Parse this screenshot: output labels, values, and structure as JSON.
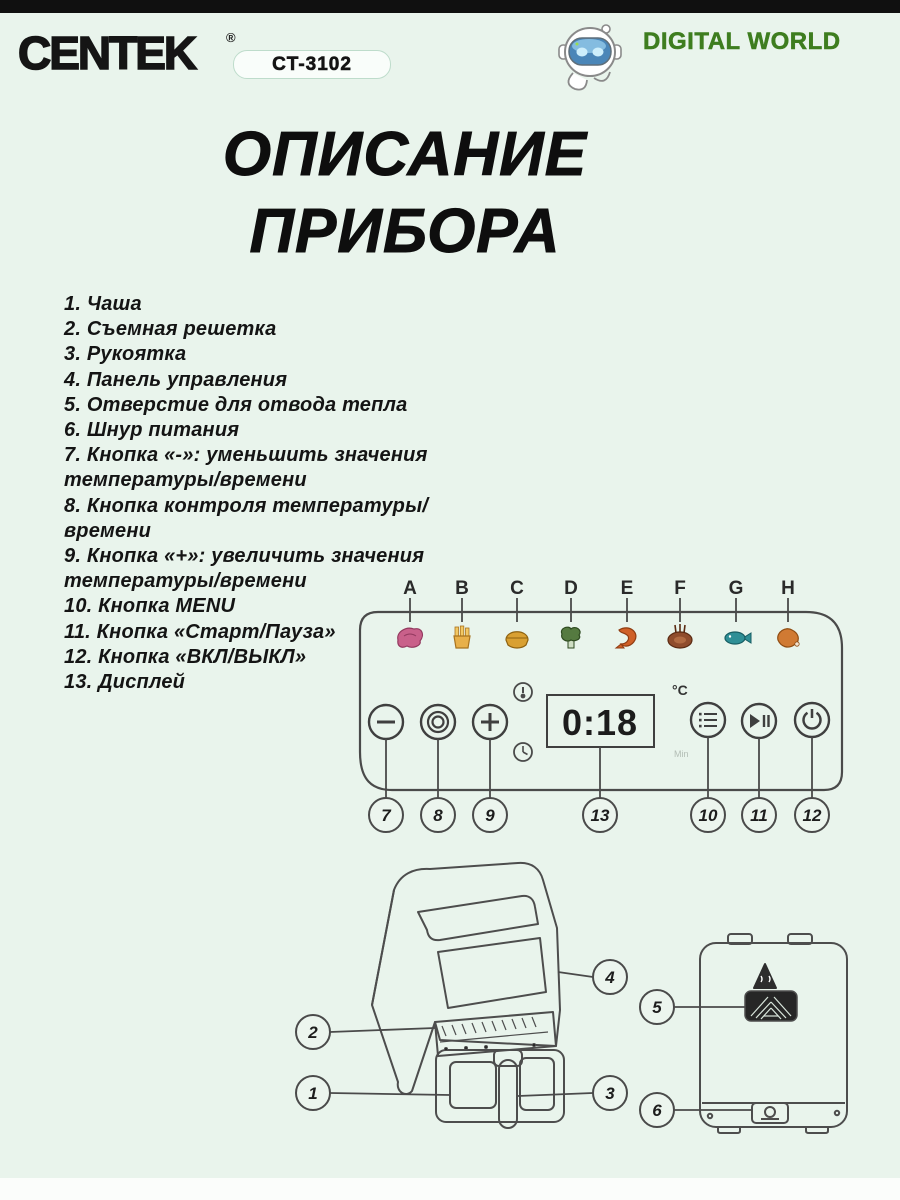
{
  "header": {
    "brand": "CENTEK",
    "registered": "®",
    "model": "CT-3102",
    "partner": "DIGITAL WORLD"
  },
  "title": {
    "line1": "ОПИСАНИЕ",
    "line2": "ПРИБОРА"
  },
  "parts_list": {
    "lines": [
      "1. Чаша",
      "2. Съемная решетка",
      "3. Рукоятка",
      "4. Панель управления",
      "5. Отверстие для отвода тепла",
      "6. Шнур питания",
      "7. Кнопка «-»: уменьшить значения",
      "температуры/времени",
      "8. Кнопка контроля температуры/",
      "времени",
      "9. Кнопка «+»: увеличить значения",
      "температуры/времени",
      "10. Кнопка MENU",
      "11. Кнопка «Старт/Пауза»",
      "12. Кнопка «ВКЛ/ВЫКЛ»",
      "13. Дисплей"
    ]
  },
  "control_panel": {
    "letters": [
      "A",
      "B",
      "C",
      "D",
      "E",
      "F",
      "G",
      "H"
    ],
    "food_icons": [
      "meat",
      "fries",
      "pie",
      "broccoli",
      "shrimp",
      "steak",
      "fish",
      "chicken-wing"
    ],
    "display": {
      "value": "0:18",
      "unit_top": "°C",
      "unit_bottom": "Min"
    },
    "buttons": [
      "minus",
      "dial",
      "plus",
      "menu",
      "play-pause",
      "power"
    ],
    "callouts": [
      "7",
      "8",
      "9",
      "13",
      "10",
      "11",
      "12"
    ]
  },
  "front_view": {
    "callout_panel": "4",
    "callout_grate": "2",
    "callout_basket": "1",
    "callout_handle": "3"
  },
  "back_view": {
    "callout_vent": "5",
    "callout_cord": "6"
  },
  "colors": {
    "background": "#e9f4ec",
    "top_bar": "#101010",
    "partner_green": "#3e7d1f",
    "line_art": "#4a4a4a"
  }
}
